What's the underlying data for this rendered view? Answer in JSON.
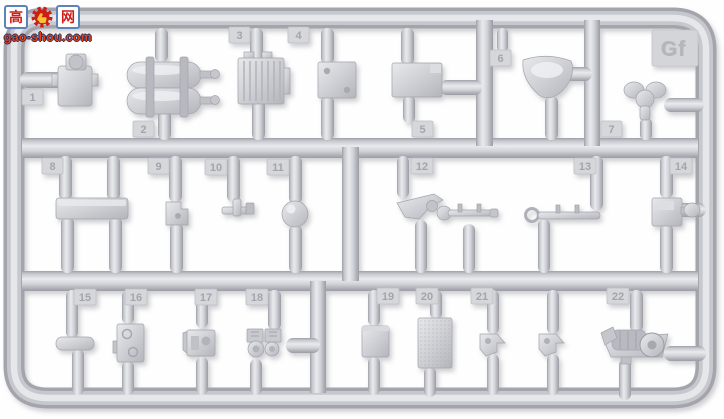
{
  "meta": {
    "image_type": "product photo of a plastic model kit sprue (runner) on white background"
  },
  "sprue": {
    "letter": "Gf",
    "plastic_color": "#cbccd1",
    "plastic_highlight": "#e9eaee",
    "plastic_shadow": "#9b9ca3",
    "background_color": "#fefefe",
    "tag_text_color": "#a4a5ac"
  },
  "watermark": {
    "char_left": "高",
    "icon": "red-gear-with-yellow-thumb",
    "char_right": "网",
    "domain": "gao-shou.com",
    "text_color": "#e8400e",
    "outline_color": "#203064",
    "box_border_color": "#5d83bb",
    "char_color": "#cf1d17",
    "gear_color": "#cf1d17",
    "thumb_color": "#f6c431"
  },
  "parts": [
    {
      "id": "1",
      "shape": "valve-block"
    },
    {
      "id": "2",
      "shape": "twin-cylinder-tanks"
    },
    {
      "id": "3",
      "shape": "ribbed-box"
    },
    {
      "id": "4",
      "shape": "drilled-plate"
    },
    {
      "id": "5",
      "shape": "stowage-box"
    },
    {
      "id": "6",
      "shape": "bowl-scoop"
    },
    {
      "id": "7",
      "shape": "pedestal-seat"
    },
    {
      "id": "8",
      "shape": "long-beam"
    },
    {
      "id": "9",
      "shape": "step-bracket"
    },
    {
      "id": "10",
      "shape": "t-fitting"
    },
    {
      "id": "11",
      "shape": "dome"
    },
    {
      "id": "12",
      "shape": "control-lever-with-rod"
    },
    {
      "id": "13",
      "shape": "crank-rod"
    },
    {
      "id": "14",
      "shape": "box-with-knob"
    },
    {
      "id": "15",
      "shape": "oval-pad"
    },
    {
      "id": "16",
      "shape": "riveted-plate"
    },
    {
      "id": "17",
      "shape": "bracket-with-boss"
    },
    {
      "id": "18",
      "shape": "gauge-cluster"
    },
    {
      "id": "19",
      "shape": "small-box"
    },
    {
      "id": "20",
      "shape": "textured-panel"
    },
    {
      "id": "21",
      "shape": "angle-clip",
      "quantity": 2
    },
    {
      "id": "22",
      "shape": "winch-assembly"
    }
  ]
}
